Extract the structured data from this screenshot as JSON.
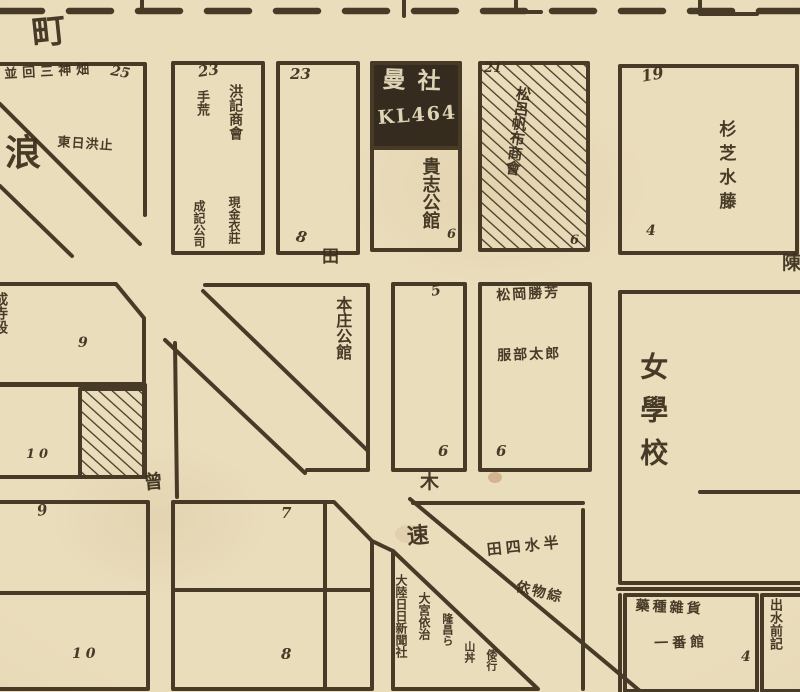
{
  "map_labels": {
    "street_top": "町",
    "street_naniwa_1": "浪",
    "street_naniwa_2": "速",
    "street_den": "田",
    "street_sou": "曾",
    "street_ki": "木",
    "street_chin": "陳",
    "block_a_owner_row": "並回三神畑",
    "block_a_lot": "25",
    "block_a_note": "東日洪止",
    "block_b1_lot": "23",
    "block_b1_col1": "洪記商會",
    "block_b1_col2": "手荒",
    "block_b1_col3": "現金衣莊",
    "block_b1_col4": "成記公司",
    "block_b2_lot": "23",
    "block_b2_sub": "8",
    "sign_line1": "曼社",
    "sign_line2": "KL464",
    "kishi_mansion": "貴志公館",
    "kishi_lot": "6",
    "block_b4_lot": "21",
    "block_b4_name": "松呂帆布商會",
    "block_b4_sub": "6",
    "block_b5_lot": "19",
    "block_b5_name": "杉芝水藤",
    "block_b5_sub": "4",
    "honjo_mansion": "本庄公館",
    "block_d_name": "成寺段",
    "block_d_lot": "9",
    "block_e_lot": "10",
    "block_m2_lot": "5",
    "block_m2_sub": "6",
    "block_m3_name1": "松岡勝芳",
    "block_m3_name2": "服部太郎",
    "block_m3_sub": "6",
    "girls_school": "女學校",
    "block_f_lot1": "9",
    "block_f_lot2": "10",
    "block_g_lot1": "7",
    "block_g_lot2": "8",
    "newspaper": "大陸日日新聞社",
    "omiya": "大宮依治",
    "ryusho": "隆昌ら",
    "yamadon": "山丼",
    "wako": "倭行",
    "block_i_name1": "田四水半",
    "block_i_name2": "依物綜",
    "block_j_name1": "藥種雜貨",
    "block_j_name2": "一番館",
    "block_j_lot": "4",
    "block_k_name": "出水前記"
  },
  "colors": {
    "paper": "#eaddbc",
    "ink": "#3a2d1b",
    "sign_bg": "#261e12",
    "sign_text": "#e9dcbe"
  }
}
